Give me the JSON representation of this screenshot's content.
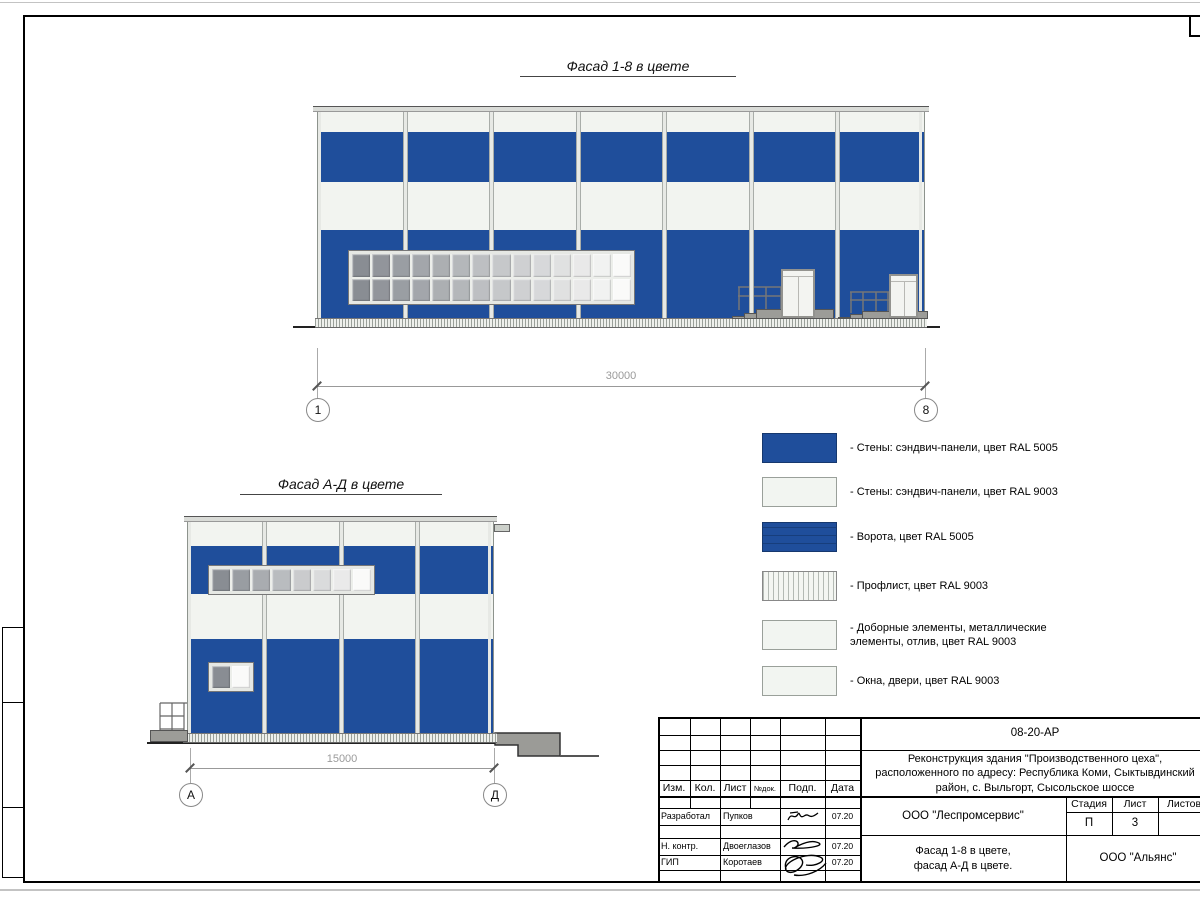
{
  "palette": {
    "wall_blue_ral5005": "#1f4e9b",
    "wall_white_ral9003": "#f2f4f0",
    "metal_gray": "#9c9c98"
  },
  "sheet": {
    "facades": [
      {
        "title": "Фасад 1-8 в цвете",
        "dimension": "30000",
        "axis_start": "1",
        "axis_end": "8"
      },
      {
        "title": "Фасад А-Д в цвете",
        "dimension": "15000",
        "axis_start": "А",
        "axis_end": "Д"
      }
    ],
    "legend": [
      {
        "swatch": "swatch-blue",
        "label": "- Стены: сэндвич-панели, цвет RAL 5005"
      },
      {
        "swatch": "swatch-white",
        "label": "- Стены: сэндвич-панели, цвет RAL 9003"
      },
      {
        "swatch": "swatch-gate",
        "label": "- Ворота, цвет RAL 5005"
      },
      {
        "swatch": "swatch-proflist",
        "label": "- Профлист, цвет RAL 9003"
      },
      {
        "swatch": "swatch-white",
        "label": "- Доборные элементы, металлические\nэлементы, отлив, цвет RAL 9003"
      },
      {
        "swatch": "swatch-white",
        "label": "- Окна, двери, цвет RAL 9003"
      }
    ],
    "title_block": {
      "doc_number": "08-20-АР",
      "project_line1": "Реконструкция здания \"Производственного цеха\",",
      "project_line2": "расположенного по адресу: Республика Коми, Сыктывдинский",
      "project_line3": "район, с. Выльгорт, Сысольское шоссе",
      "columns": {
        "izm": "Изм.",
        "kol": "Кол.",
        "list": "Лист",
        "ndoc": "№док.",
        "podp": "Подп.",
        "data": "Дата"
      },
      "rows": [
        {
          "role": "Разработал",
          "name": "Пупков",
          "date": "07.20"
        },
        {
          "role": "Н. контр.",
          "name": "Двоеглазов",
          "date": "07.20"
        },
        {
          "role": "ГИП",
          "name": "Коротаев",
          "date": "07.20"
        }
      ],
      "org_design": "ООО \"Леспромсервис\"",
      "sheet_title_line1": "Фасад 1-8 в цвете,",
      "sheet_title_line2": "фасад А-Д в цвете.",
      "stage_label": "Стадия",
      "sheet_label": "Лист",
      "sheets_label": "Листов",
      "stage_value": "П",
      "sheet_value": "3",
      "org_customer": "ООО \"Альянс\""
    }
  }
}
